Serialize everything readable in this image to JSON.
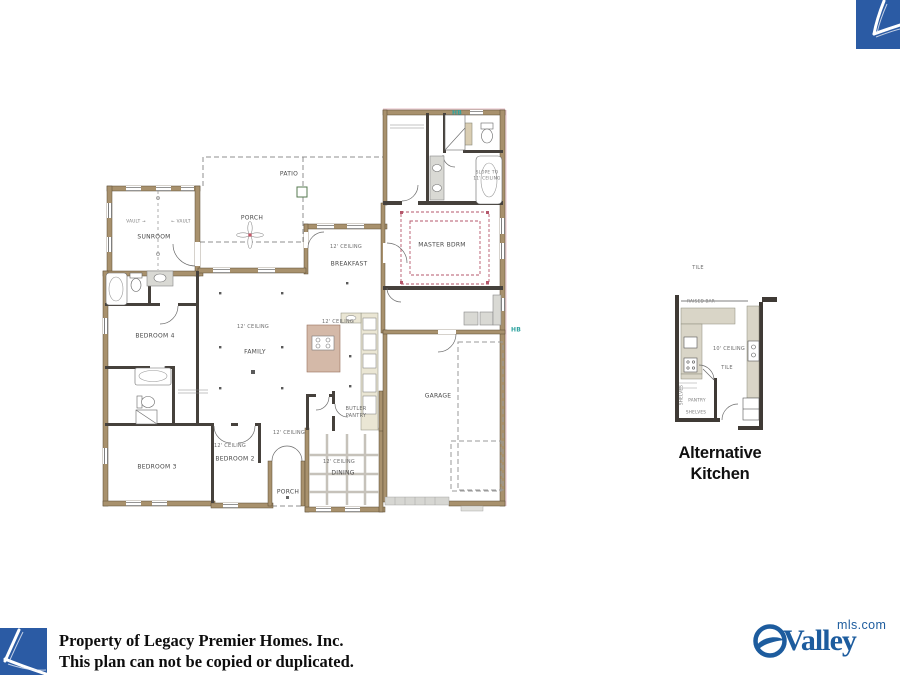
{
  "colors": {
    "brand_blue": "#2b5ba4",
    "valley_blue": "#1d5c9e",
    "hb_teal": "#2fa3a0",
    "wall_tan": "#a8916d",
    "tray_pink": "#b5576b"
  },
  "footer": {
    "line1": "Property of Legacy Premier Homes. Inc.",
    "line2": "This plan can not be copied or duplicated."
  },
  "valley_logo": {
    "wordmark": "Valley",
    "domain": "mls.com"
  },
  "alt_kitchen": {
    "title_line1": "Alternative",
    "title_line2": "Kitchen",
    "labels": [
      {
        "id": "tile-top",
        "text": "TILE",
        "x": 698,
        "y": 268,
        "cls": "note"
      },
      {
        "id": "raised-bar",
        "text": "RAISED BAR",
        "x": 701,
        "y": 301,
        "cls": "tiny"
      },
      {
        "id": "ceiling-10ft",
        "text": "10' CEILING",
        "x": 729,
        "y": 349,
        "cls": "note"
      },
      {
        "id": "tile-floor",
        "text": "TILE",
        "x": 727,
        "y": 368,
        "cls": "note"
      },
      {
        "id": "pantry",
        "text": "PANTRY",
        "x": 697,
        "y": 400,
        "cls": "tiny"
      },
      {
        "id": "shelves-side",
        "text": "SHELVES",
        "x": 681,
        "y": 395,
        "cls": "tiny",
        "rot": -90
      },
      {
        "id": "shelves-bottom",
        "text": "SHELVES",
        "x": 696,
        "y": 412,
        "cls": "tiny"
      }
    ]
  },
  "floorplan": {
    "labels": [
      {
        "id": "patio",
        "text": "PATIO",
        "x": 289,
        "y": 174
      },
      {
        "id": "back-porch",
        "text": "PORCH",
        "x": 252,
        "y": 218
      },
      {
        "id": "sunroom",
        "text": "SUNROOM",
        "x": 154,
        "y": 237
      },
      {
        "id": "vault-left",
        "text": "VAULT →",
        "x": 136,
        "y": 221,
        "cls": "tiny"
      },
      {
        "id": "vault-right",
        "text": "← VAULT",
        "x": 181,
        "y": 221,
        "cls": "tiny"
      },
      {
        "id": "hb-top",
        "text": "HB",
        "x": 457,
        "y": 113,
        "cls": "hb"
      },
      {
        "id": "hb-right",
        "text": "HB",
        "x": 516,
        "y": 330,
        "cls": "hb"
      },
      {
        "id": "slope-1",
        "text": "SLOPE TO",
        "x": 487,
        "y": 172,
        "cls": "tiny"
      },
      {
        "id": "slope-2",
        "text": "11' CEILING",
        "x": 487,
        "y": 178,
        "cls": "tiny"
      },
      {
        "id": "master-bdrm",
        "text": "MASTER BDRM",
        "x": 442,
        "y": 245
      },
      {
        "id": "ceiling-breakfast",
        "text": "12' CEILING",
        "x": 346,
        "y": 247,
        "cls": "note"
      },
      {
        "id": "breakfast",
        "text": "BREAKFAST",
        "x": 349,
        "y": 264
      },
      {
        "id": "ceiling-family",
        "text": "12' CEILING",
        "x": 253,
        "y": 327,
        "cls": "note"
      },
      {
        "id": "family",
        "text": "FAMILY",
        "x": 255,
        "y": 352
      },
      {
        "id": "bedroom-4",
        "text": "BEDROOM 4",
        "x": 155,
        "y": 336
      },
      {
        "id": "ceiling-kitchen",
        "text": "12' CEILING",
        "x": 338,
        "y": 322,
        "cls": "note"
      },
      {
        "id": "garage",
        "text": "GARAGE",
        "x": 438,
        "y": 396
      },
      {
        "id": "butler-1",
        "text": "BUTLER",
        "x": 356,
        "y": 409,
        "cls": "note"
      },
      {
        "id": "butler-2",
        "text": "PANTRY",
        "x": 356,
        "y": 416,
        "cls": "note"
      },
      {
        "id": "bedroom-3",
        "text": "BEDROOM 3",
        "x": 157,
        "y": 467
      },
      {
        "id": "ceiling-bed2",
        "text": "12' CEILING",
        "x": 230,
        "y": 446,
        "cls": "note"
      },
      {
        "id": "bedroom-2",
        "text": "BEDROOM 2",
        "x": 235,
        "y": 459
      },
      {
        "id": "ceiling-foyer",
        "text": "12' CEILING",
        "x": 289,
        "y": 433,
        "cls": "note"
      },
      {
        "id": "ceiling-dining",
        "text": "12' CEILING",
        "x": 339,
        "y": 462,
        "cls": "note"
      },
      {
        "id": "dining",
        "text": "DINING",
        "x": 343,
        "y": 473
      },
      {
        "id": "front-porch",
        "text": "PORCH",
        "x": 288,
        "y": 492
      }
    ]
  }
}
